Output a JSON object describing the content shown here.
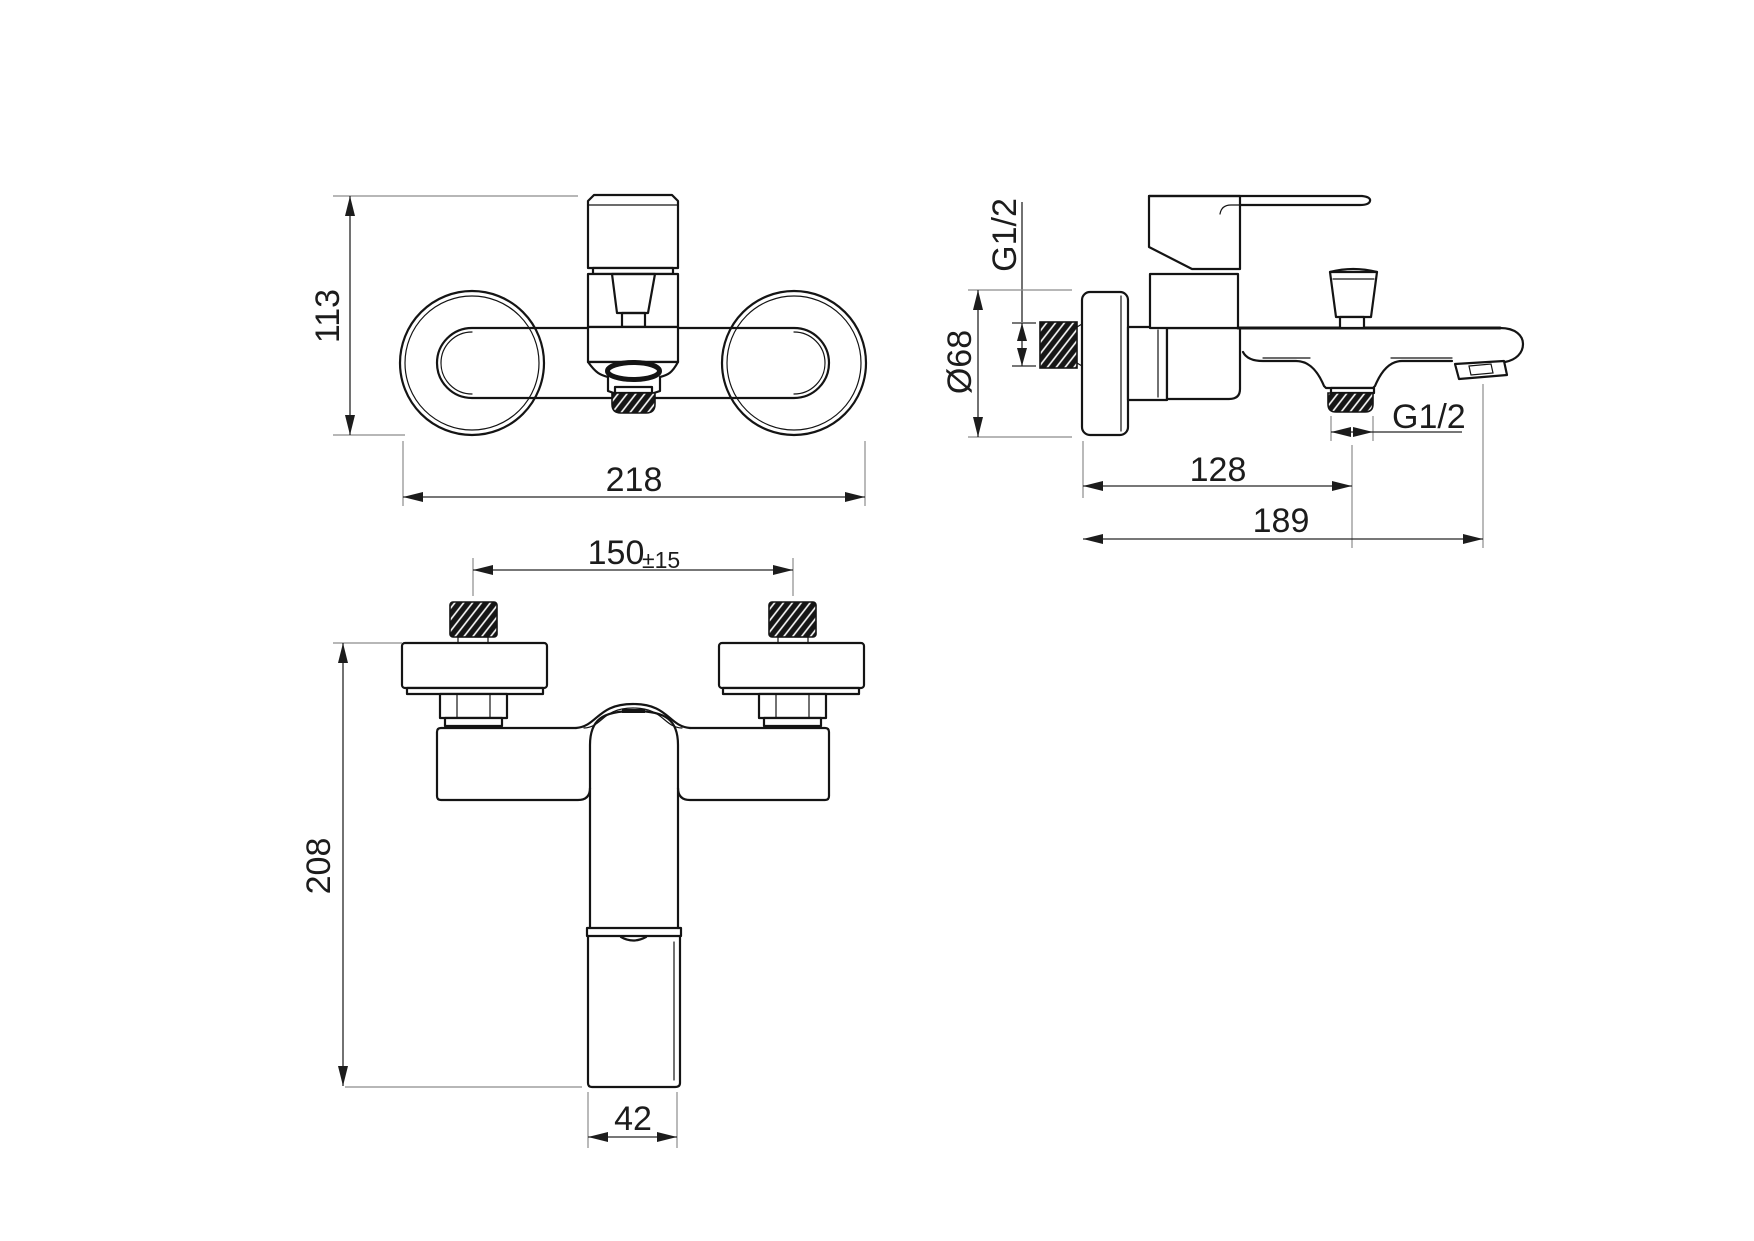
{
  "drawing": {
    "type": "technical-dimension-drawing",
    "subject": "wall-mounted bath mixer faucet, three orthographic views",
    "views": {
      "top": {
        "height_mm": "113",
        "width_mm": "218"
      },
      "side": {
        "inlet_thread": "G1/2",
        "flange_diameter": "Ø68",
        "outlet_thread": "G1/2",
        "wall_to_outlet_mm": "128",
        "wall_to_spout_tip_mm": "189"
      },
      "bottom": {
        "inlet_spacing_mm": "150",
        "inlet_spacing_tolerance": "±15",
        "total_depth_mm": "208",
        "spout_width_mm": "42"
      }
    },
    "colors": {
      "line": "#141414",
      "dimension": "#262626",
      "extension": "#8c8c8c",
      "background": "#ffffff"
    }
  }
}
